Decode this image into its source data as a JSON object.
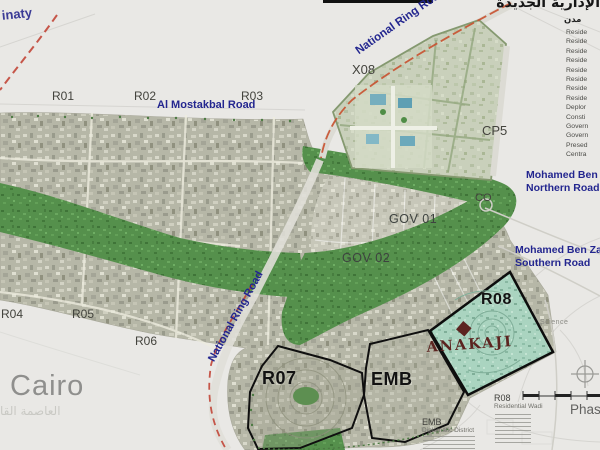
{
  "map_title_ar": "الإدارية الجديدة",
  "corner_label": "inaty",
  "city": {
    "name": "Cairo",
    "name_ar": "العاصمة القا"
  },
  "roads": {
    "national_ring_top": "National Ring Road",
    "national_ring_bottom": "National Ring Road",
    "al_mostakbal": "Al Mostakbal Road",
    "mbz_north_1": "Mohamed Ben Zayed",
    "mbz_north_2": "Northern Road",
    "mbz_south_1": "Mohamed Ben Zayed",
    "mbz_south_2": "Southern Road"
  },
  "districts": {
    "r01": "R01",
    "r02": "R02",
    "r03": "R03",
    "r04": "R04",
    "r05": "R05",
    "r06": "R06",
    "r07": "R07",
    "emb": "EMB",
    "r08": "R08",
    "x08": "X08",
    "cp5": "CP5",
    "co": "CO",
    "gov01": "GOV 01",
    "gov02": "GOV 02"
  },
  "logo": {
    "name": "ANAKAJI"
  },
  "notes": {
    "science": "Science",
    "phase": "Phase",
    "r08_title": "R08",
    "r08_sub": "Residential Wadi",
    "emb_title": "EMB",
    "emb_sub": "Diplomatic District"
  },
  "legend": {
    "header_ar": "مدن",
    "items": [
      "Reside",
      "Reside",
      "Reside",
      "Reside",
      "Reside",
      "Reside",
      "Reside",
      "Reside",
      "Deplor",
      "Consti",
      "Govern",
      "Govern",
      "Presed",
      "Centra"
    ]
  },
  "colors": {
    "road_label_blue": "#23268f",
    "ring_road_red": "#bf3c2e",
    "green_river": "#55904c",
    "r08_parcel_teal": "#aad4c0",
    "urban_fabric": "#b6b7a7",
    "logo_maroon": "#5c2420",
    "background": "#e9e8e5"
  }
}
